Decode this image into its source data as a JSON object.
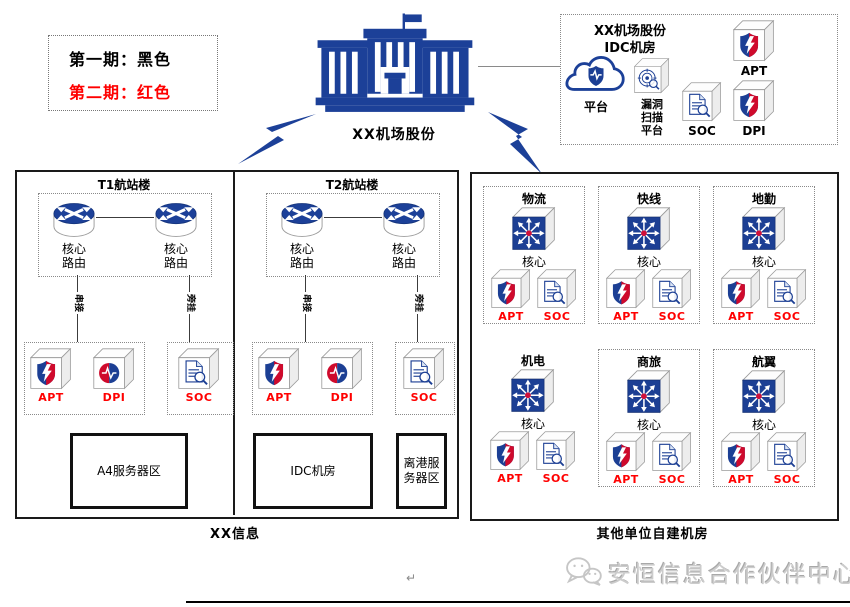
{
  "colors": {
    "primary_blue": "#1c4098",
    "shield_blue": "#1c3f94",
    "shield_red": "#cf0a2c",
    "phase2_red": "#ff0000",
    "text_black": "#000000",
    "watermark_gray": "#cccccc"
  },
  "legend": {
    "items": [
      {
        "label": "第一期：",
        "value": "黑色"
      },
      {
        "label": "第二期：",
        "value": "红色"
      }
    ]
  },
  "hq": {
    "label": "XX机场股份"
  },
  "idc": {
    "title1": "XX机场股份",
    "title2": "IDC机房",
    "platform": "平台",
    "scanner": [
      "漏洞",
      "扫描",
      "平台"
    ],
    "soc": "SOC",
    "apt": "APT",
    "dpi": "DPI"
  },
  "left_panel": {
    "footer": "XX信息",
    "terminals": [
      {
        "title": "T1航站楼",
        "router_label": [
          "核心",
          "路由"
        ],
        "link_left": "串接",
        "link_right": "旁挂",
        "apt": "APT",
        "dpi": "DPI",
        "soc": "SOC",
        "room1": "A4服务器区"
      },
      {
        "title": "T2航站楼",
        "router_label": [
          "核心",
          "路由"
        ],
        "link_left": "串接",
        "link_right": "旁挂",
        "apt": "APT",
        "dpi": "DPI",
        "soc": "SOC",
        "room1": "IDC机房",
        "room2": "离港服务器区"
      }
    ]
  },
  "right_panel": {
    "footer": "其他单位自建机房",
    "units": [
      {
        "title": "物流",
        "core": "核心",
        "apt": "APT",
        "soc": "SOC"
      },
      {
        "title": "快线",
        "core": "核心",
        "apt": "APT",
        "soc": "SOC"
      },
      {
        "title": "地勤",
        "core": "核心",
        "apt": "APT",
        "soc": "SOC"
      },
      {
        "title": "机电",
        "core": "核心",
        "apt": "APT",
        "soc": "SOC"
      },
      {
        "title": "商旅",
        "core": "核心",
        "apt": "APT",
        "soc": "SOC"
      },
      {
        "title": "航翼",
        "core": "核心",
        "apt": "APT",
        "soc": "SOC"
      }
    ]
  },
  "watermark": {
    "text": "安恒信息合作伙伴中心"
  },
  "marks": {
    "return_mark": "↵"
  }
}
